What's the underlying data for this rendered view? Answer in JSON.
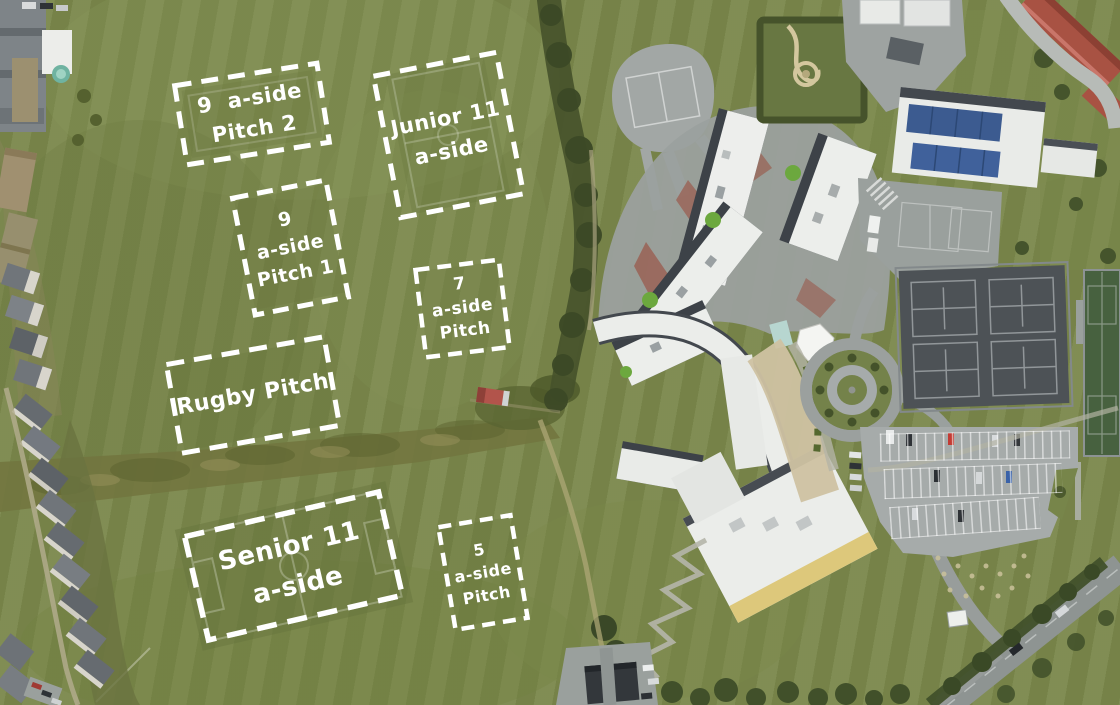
{
  "annotations": {
    "pitches": [
      {
        "id": "nine-a-side-pitch-2",
        "lines": [
          "9  a-side",
          "Pitch 2"
        ]
      },
      {
        "id": "junior-11-a-side",
        "lines": [
          "Junior 11",
          "a-side"
        ]
      },
      {
        "id": "nine-a-side-pitch-1",
        "lines": [
          "9",
          "a-side",
          "Pitch 1"
        ]
      },
      {
        "id": "seven-a-side-pitch",
        "lines": [
          "7",
          "a-side",
          "Pitch"
        ]
      },
      {
        "id": "rugby-pitch",
        "lines": [
          "Rugby Pitch"
        ]
      },
      {
        "id": "senior-11-a-side",
        "lines": [
          "Senior 11",
          "a-side"
        ]
      },
      {
        "id": "five-a-side-pitch",
        "lines": [
          "5",
          "a-side",
          "Pitch"
        ]
      }
    ]
  },
  "colors": {
    "grass": "#7b884c",
    "annotation_white": "#ffffff",
    "roof_white": "#ebedea",
    "tarmac": "#9ba09e",
    "court_surface": "#4d5256",
    "road": "#8f9593",
    "red_roof": "#a85243",
    "solar_panel": "#3c5b90",
    "hedge": "#46522b",
    "courtyard_tan": "#cfc2a2"
  }
}
